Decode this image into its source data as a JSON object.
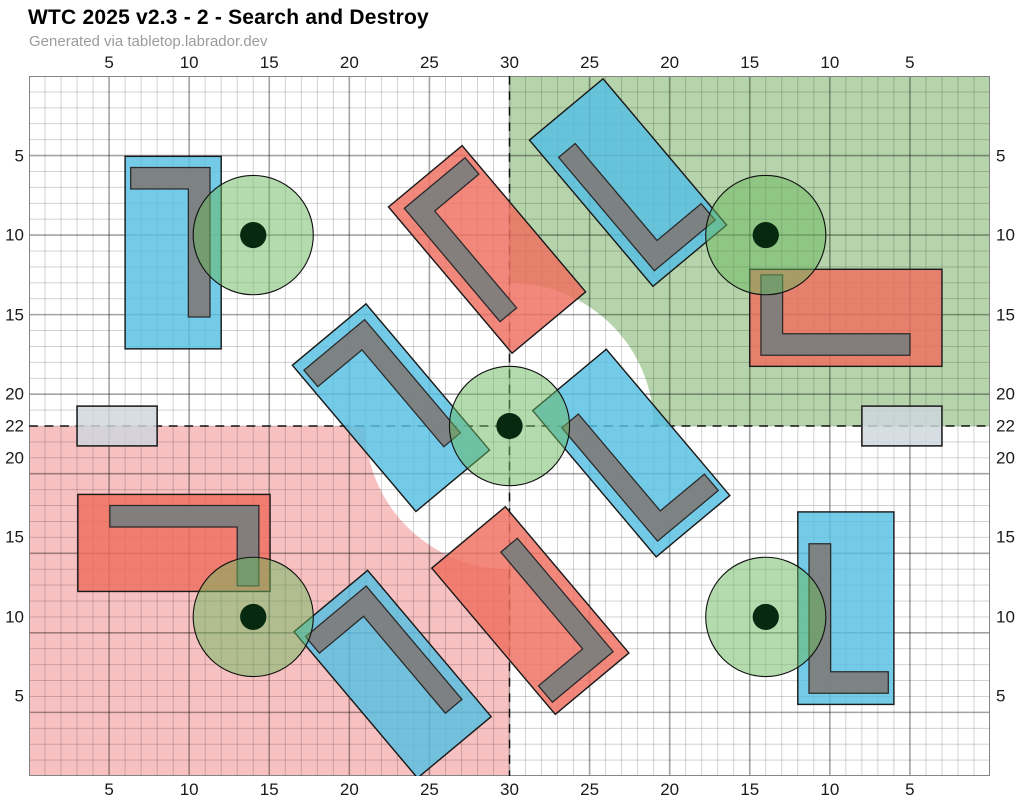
{
  "header": {
    "title": "WTC 2025 v2.3 - 2 - Search and Destroy",
    "subtitle": "Generated via tabletop.labrador.dev"
  },
  "board": {
    "width_in": 60,
    "height_in": 44,
    "axes": {
      "top_bottom_ticks": [
        {
          "pos": 5,
          "label": "5"
        },
        {
          "pos": 10,
          "label": "10"
        },
        {
          "pos": 15,
          "label": "15"
        },
        {
          "pos": 20,
          "label": "20"
        },
        {
          "pos": 25,
          "label": "25"
        },
        {
          "pos": 30,
          "label": "30"
        },
        {
          "pos": 35,
          "label": "25"
        },
        {
          "pos": 40,
          "label": "20"
        },
        {
          "pos": 45,
          "label": "15"
        },
        {
          "pos": 50,
          "label": "10"
        },
        {
          "pos": 55,
          "label": "5"
        }
      ],
      "left_right_ticks": [
        {
          "pos": 5,
          "label": "5"
        },
        {
          "pos": 10,
          "label": "10"
        },
        {
          "pos": 15,
          "label": "15"
        },
        {
          "pos": 20,
          "label": "20"
        },
        {
          "pos": 22,
          "label": "22"
        },
        {
          "pos": 24,
          "label": "20"
        },
        {
          "pos": 29,
          "label": "15"
        },
        {
          "pos": 34,
          "label": "10"
        },
        {
          "pos": 39,
          "label": "5"
        }
      ]
    },
    "colors": {
      "zone_green": "#b6d4ab",
      "zone_red": "#f8c1c1",
      "terrain_blue": "#55bfe3",
      "terrain_red": "#ef6e5e",
      "wall_gray": "#7d7d7d",
      "wall_outline": "#2a2a2a",
      "terrain_outline": "#1a1a1a",
      "marker_gray": "#cdd7de",
      "objective_green": "#69b85e",
      "objective_dot": "#06290f",
      "grid_minor": "rgba(0,0,0,0.20)",
      "grid_major": "rgba(0,0,0,0.36)",
      "border": "#808080",
      "midline": "#111111"
    },
    "deployment_zones": [
      {
        "name": "green",
        "corner": "top-right",
        "cut_radius_in": 9
      },
      {
        "name": "red",
        "corner": "bottom-left",
        "cut_radius_in": 9
      }
    ],
    "midlines": {
      "vertical_x": 30,
      "horizontal_y": 22
    },
    "objectives": {
      "radius_in": 3.75,
      "dot_radius_in": 0.82,
      "points": [
        {
          "x": 14,
          "y": 10
        },
        {
          "x": 46,
          "y": 10
        },
        {
          "x": 30,
          "y": 22
        },
        {
          "x": 14,
          "y": 34
        },
        {
          "x": 46,
          "y": 34
        }
      ]
    },
    "terrain": [
      {
        "color": "blue",
        "cx": 9.0,
        "cy": 11.1,
        "w": 6,
        "h": 12.1,
        "rot": 0,
        "l_edges": [
          "top",
          "right"
        ]
      },
      {
        "color": "red",
        "cx": 51.0,
        "cy": 15.2,
        "w": 12,
        "h": 6.1,
        "rot": 0,
        "l_edges": [
          "left",
          "bottom"
        ]
      },
      {
        "color": "red",
        "cx": 9.05,
        "cy": 29.35,
        "w": 12,
        "h": 6.1,
        "rot": 0,
        "l_edges": [
          "right",
          "top"
        ]
      },
      {
        "color": "blue",
        "cx": 51.0,
        "cy": 33.45,
        "w": 6,
        "h": 12.1,
        "rot": 0,
        "l_edges": [
          "bottom",
          "left"
        ]
      },
      {
        "color": "red",
        "cx": 28.6,
        "cy": 10.9,
        "w": 6,
        "h": 12,
        "rot": -40,
        "l_edges": [
          "top",
          "left"
        ]
      },
      {
        "color": "blue",
        "cx": 37.4,
        "cy": 6.7,
        "w": 6,
        "h": 12,
        "rot": -40,
        "l_edges": [
          "bottom",
          "left"
        ]
      },
      {
        "color": "blue",
        "cx": 22.6,
        "cy": 20.85,
        "w": 6,
        "h": 12,
        "rot": -40,
        "l_edges": [
          "top",
          "right"
        ]
      },
      {
        "color": "blue",
        "cx": 37.6,
        "cy": 23.7,
        "w": 6,
        "h": 12,
        "rot": -40,
        "l_edges": [
          "bottom",
          "left"
        ]
      },
      {
        "color": "blue",
        "cx": 22.7,
        "cy": 37.6,
        "w": 6,
        "h": 12,
        "rot": -40,
        "l_edges": [
          "top",
          "right"
        ]
      },
      {
        "color": "red",
        "cx": 31.3,
        "cy": 33.6,
        "w": 6,
        "h": 12,
        "rot": -40,
        "l_edges": [
          "bottom",
          "right"
        ]
      }
    ],
    "edge_markers": [
      {
        "x": 3,
        "y": 20.75,
        "w": 5,
        "h": 2.5
      },
      {
        "x": 52,
        "y": 20.75,
        "w": 5,
        "h": 2.5
      }
    ]
  }
}
